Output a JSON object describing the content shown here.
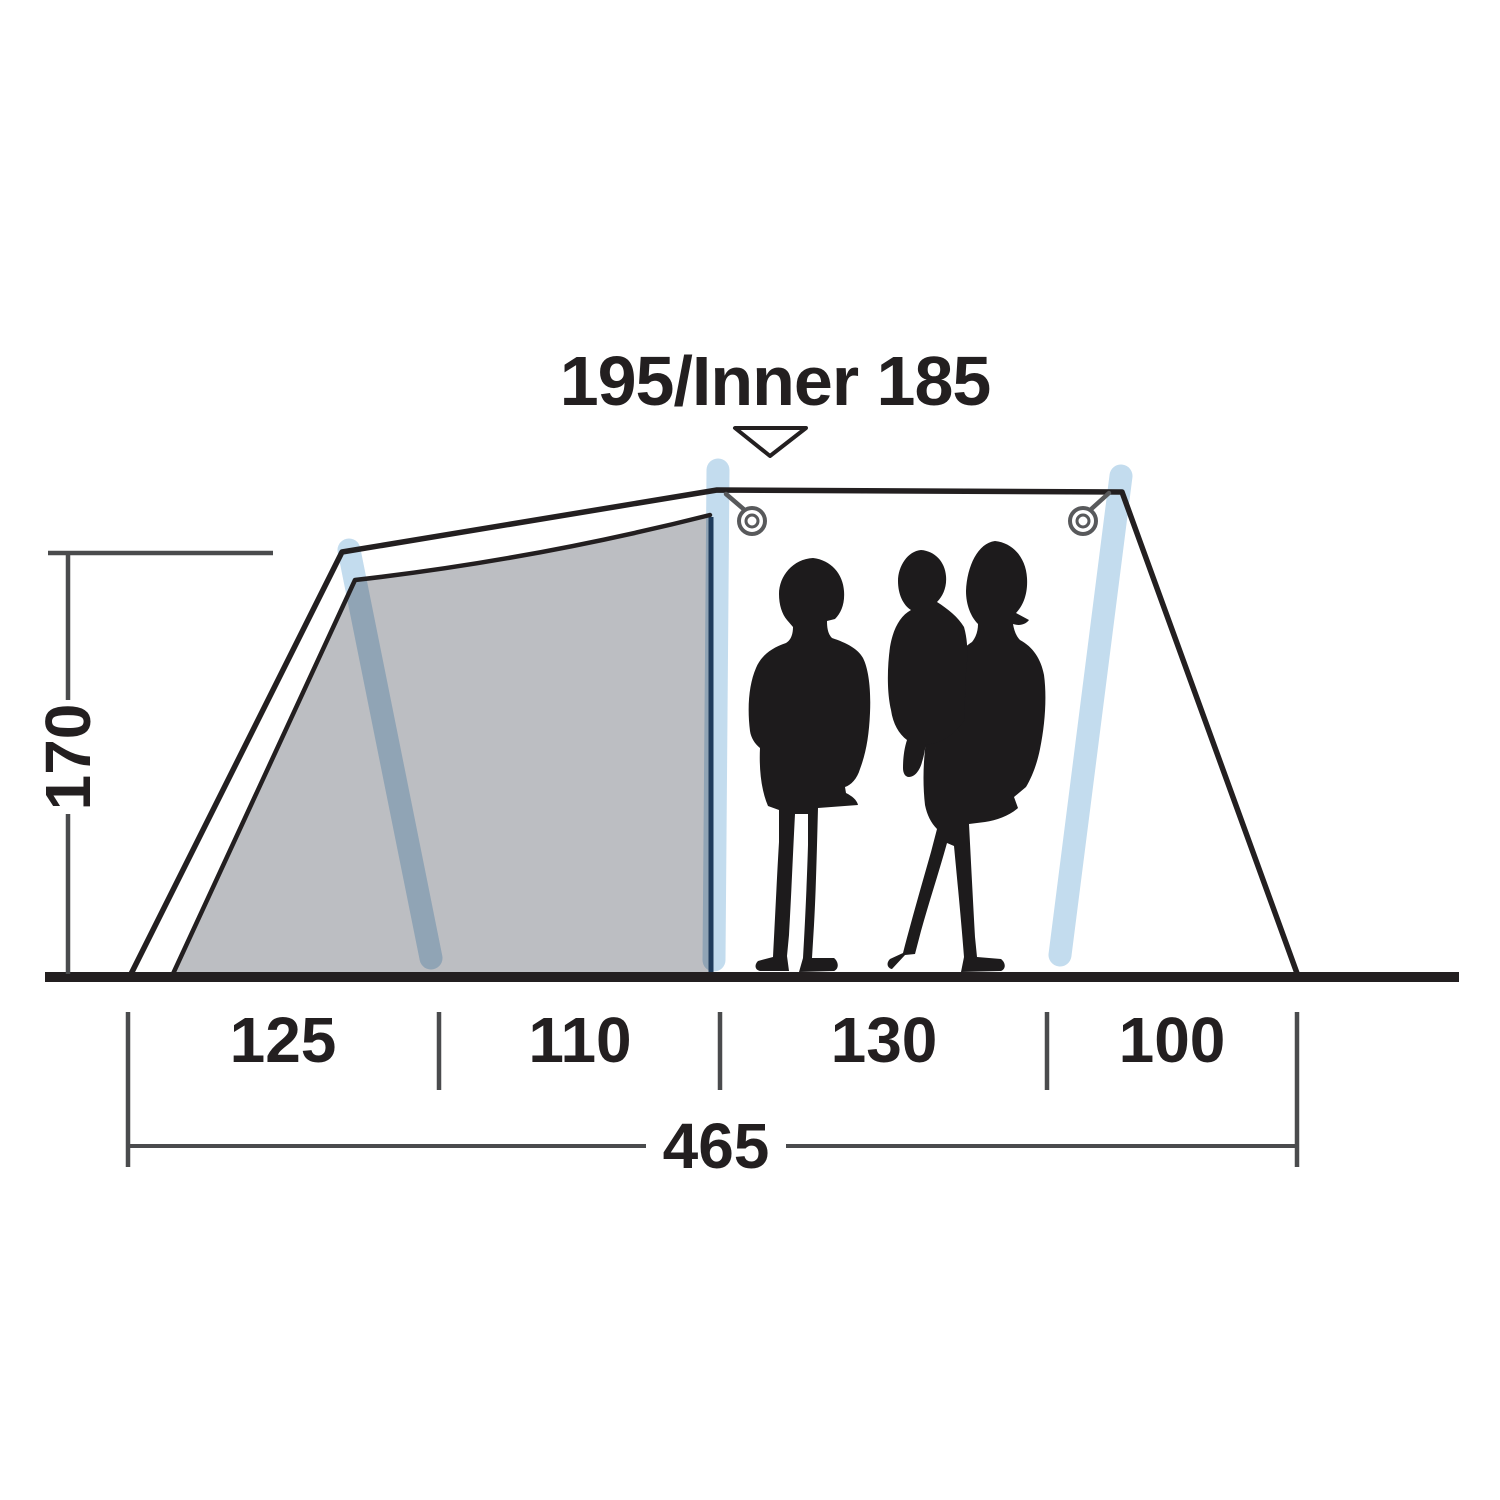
{
  "diagram": {
    "type": "tent-side-profile-dimension-diagram",
    "peak_height_label": "195/Inner 185",
    "left_height_label": "170",
    "floor_segment_labels": [
      "125",
      "110",
      "130",
      "100"
    ],
    "total_width_label": "465"
  },
  "colors": {
    "line": "#231f20",
    "dimension_line": "#4a4b4d",
    "inner_panel_fill": "#bcbec2",
    "inner_panel_edge": "#1f3c5c",
    "air_pole": "#c3dcee",
    "silhouette": "#1d1b1c"
  }
}
